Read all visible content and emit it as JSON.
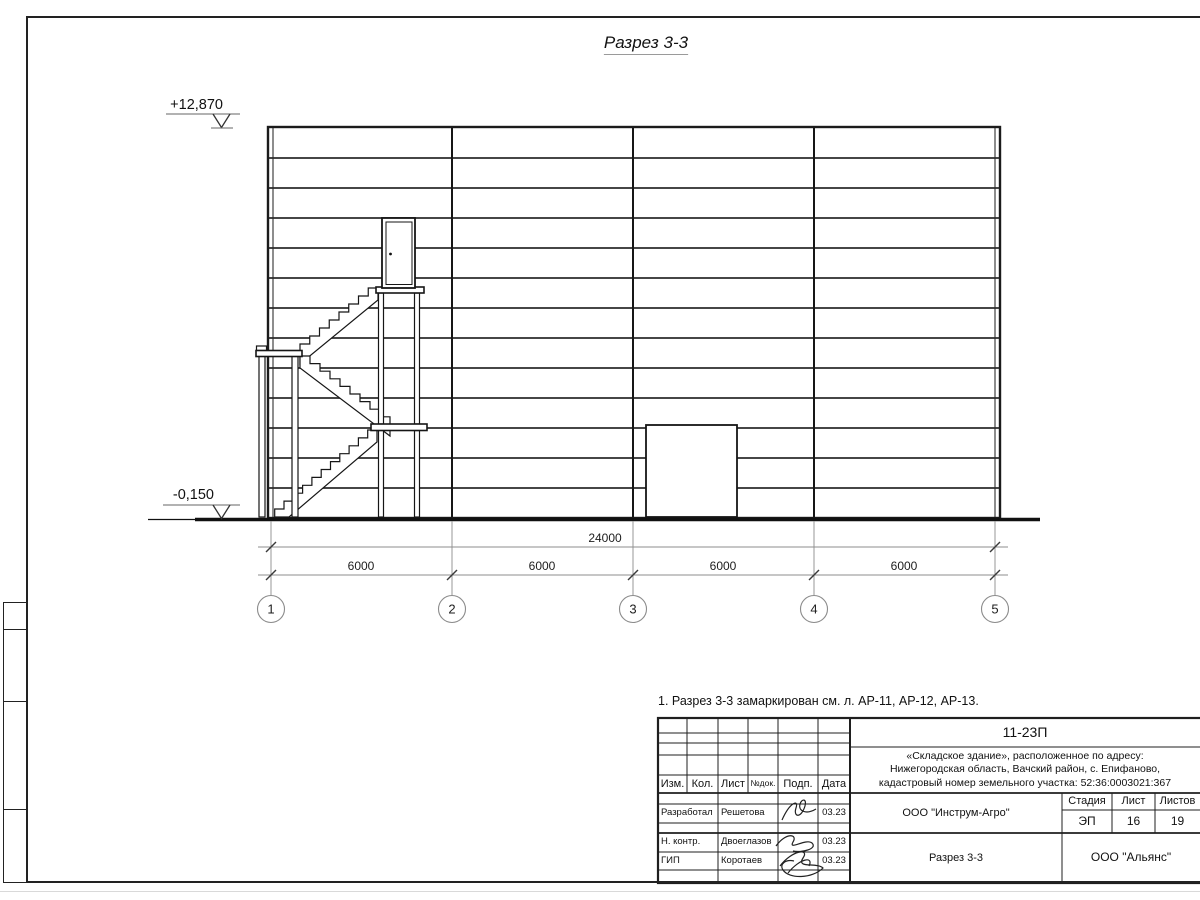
{
  "page": {
    "title": "Разрез 3-3",
    "note": "1. Разрез 3-3 замаркирован см. л. АР-11, АР-12, АР-13."
  },
  "drawing": {
    "elevations": {
      "top": "+12,870",
      "bottom": "-0,150"
    },
    "dimensions": {
      "total": "24000",
      "bays": [
        "6000",
        "6000",
        "6000",
        "6000"
      ]
    },
    "axes": [
      "1",
      "2",
      "3",
      "4",
      "5"
    ]
  },
  "titleblock": {
    "doc_number": "11-23П",
    "project": [
      "«Складское здание», расположенное по адресу:",
      "Нижегородская область, Вачский район, с. Епифаново,",
      "кадастровый номер земельного участка: 52:36:0003021:367"
    ],
    "cols": {
      "izm": "Изм.",
      "kol": "Кол.",
      "list": "Лист",
      "ndok": "№док.",
      "podp": "Подп.",
      "data": "Дата"
    },
    "rows": [
      {
        "role": "Разработал",
        "name": "Решетова",
        "date": "03.23"
      },
      {
        "role": "Н. контр.",
        "name": "Двоеглазов",
        "date": "03.23"
      },
      {
        "role": "ГИП",
        "name": "Коротаев",
        "date": "03.23"
      }
    ],
    "org_design": "ООО \"Инструм-Агро\"",
    "stage_label": "Стадия",
    "sheet_label": "Лист",
    "sheets_label": "Листов",
    "stage": "ЭП",
    "sheet_no": "16",
    "sheets_total": "19",
    "drawing_name": "Разрез 3-3",
    "org_customer": "ООО \"Альянс\""
  },
  "colors": {
    "line": "#1b1b1b",
    "dim": "#8c8c8c",
    "bg": "#ffffff"
  }
}
